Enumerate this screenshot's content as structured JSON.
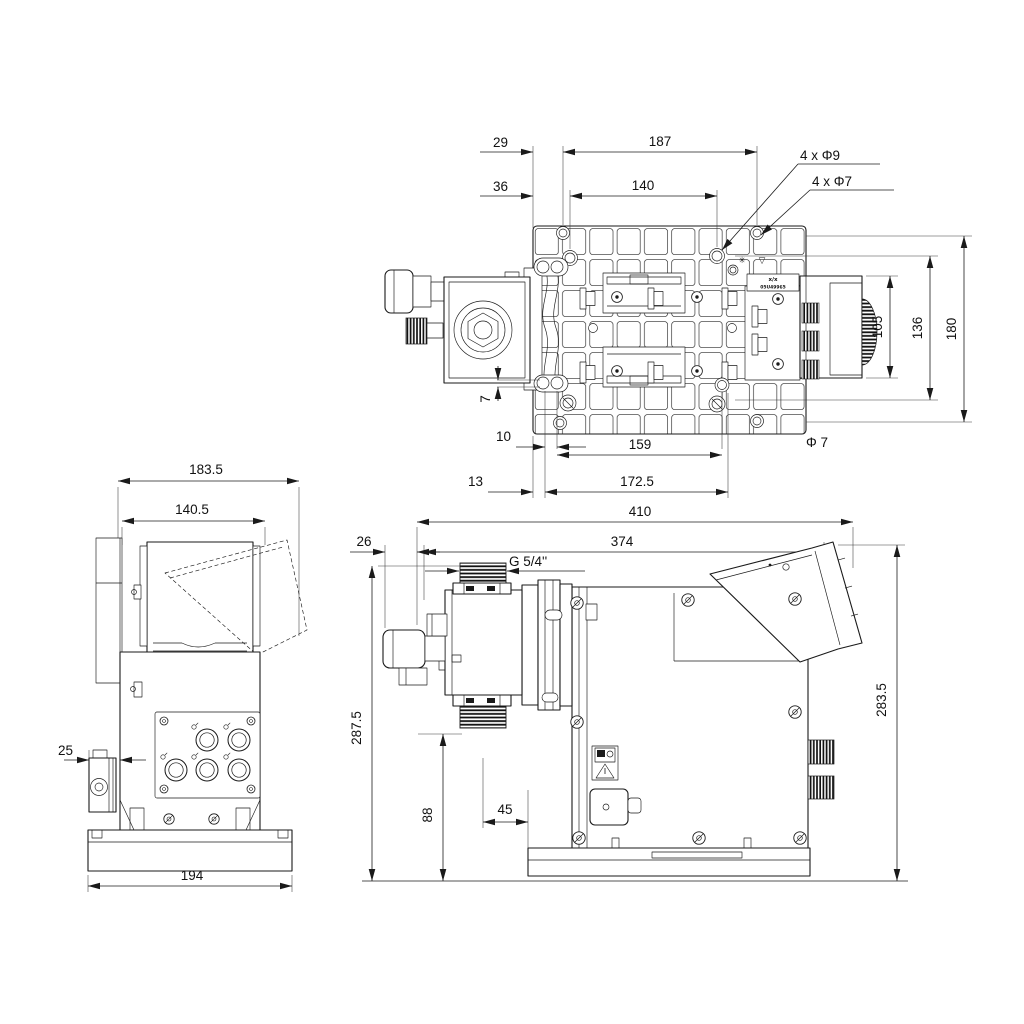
{
  "colors": {
    "background": "#ffffff",
    "line": "#1a1a1a"
  },
  "dims": {
    "top": {
      "d29": "29",
      "d187": "187",
      "d36": "36",
      "d140": "140",
      "holes_d9": "4 x Φ9",
      "holes_d7": "4 x Φ7",
      "d105": "105",
      "d136": "136",
      "d180": "180",
      "d7": "7",
      "d10": "10",
      "d159": "159",
      "dia7": "Φ 7",
      "d13": "13",
      "d172_5": "172.5"
    },
    "back": {
      "d183_5": "183.5",
      "d140_5": "140.5",
      "d25": "25",
      "d194": "194"
    },
    "side": {
      "d410": "410",
      "d26": "26",
      "d374": "374",
      "thread": "G 5/4''",
      "d287_5": "287.5",
      "d283_5": "283.5",
      "d88": "88",
      "d45": "45"
    }
  },
  "nameplate": {
    "line1": "x/x",
    "line2": "05U49965"
  },
  "plate_icons": {
    "gear_icon": "✳",
    "recycle_icon": "▽"
  }
}
